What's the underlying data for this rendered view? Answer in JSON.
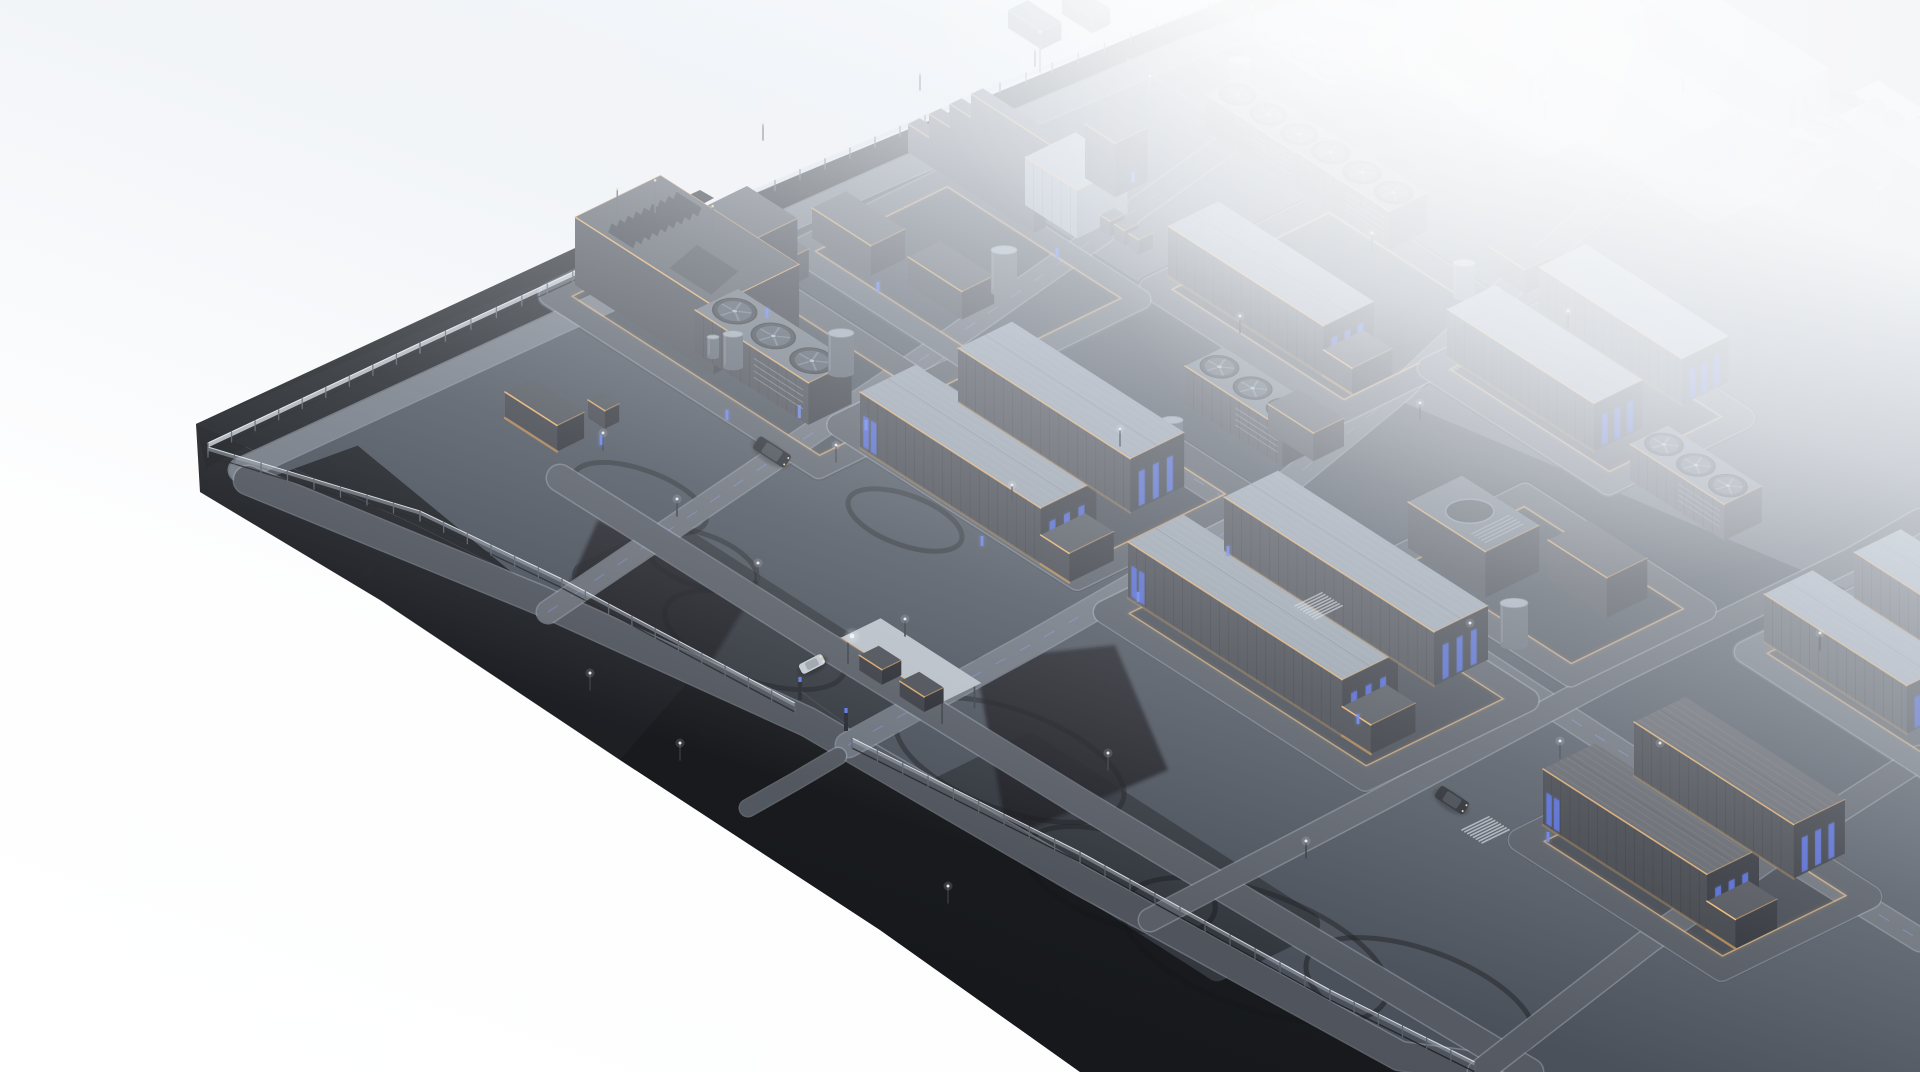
{
  "meta": {
    "scene": "battery-energy-storage-facility-aerial-render"
  },
  "projection": {
    "u": [
      0.84,
      0.54
    ],
    "v": [
      0.9,
      -0.44
    ]
  },
  "colors": {
    "void": "#ffffff",
    "fog": "#c9d1db",
    "soil": "#191c21",
    "facetA": "#15171a",
    "facetB": "#1a1c21",
    "facetDark": "#101216",
    "outside": "#404347",
    "pavement": "#333942",
    "pad": "#282d35",
    "asphalt": "#3f444c",
    "roadEdge": "#9aa2ad",
    "roof": "#8d96a1",
    "roofDark": "#4c4f54",
    "fanRoof": "#5d646d",
    "slabTop": "#3a3d43",
    "wallSide": "#27292e",
    "wallEnd": "#15171c",
    "boxLightWall": "#8e99a4",
    "boxLightWall2": "#6d7883",
    "boxLightRoof": "#a9b1bb",
    "tankBody": "#464c55",
    "tankTop": "#97a0aa",
    "amber": "#ffb964",
    "amberDim": "#c98d42",
    "blue": "#3c55d6",
    "blueBright": "#5b79f0",
    "fence": "#e4e9f0",
    "fencePost": "#565c64"
  },
  "platform": {
    "surface": [
      [
        196,
        424
      ],
      [
        1245,
        -10
      ],
      [
        1520,
        -10
      ],
      [
        1920,
        118
      ],
      [
        1920,
        1072
      ],
      [
        1470,
        1072
      ],
      [
        1300,
        985
      ],
      [
        1000,
        830
      ],
      [
        700,
        668
      ],
      [
        420,
        527
      ]
    ],
    "facetA": [
      [
        196,
        424
      ],
      [
        700,
        190
      ],
      [
        714,
        198
      ],
      [
        206,
        468
      ]
    ],
    "facetB": [
      [
        196,
        424
      ],
      [
        420,
        527
      ],
      [
        700,
        668
      ],
      [
        1000,
        830
      ],
      [
        1300,
        985
      ],
      [
        1470,
        1072
      ],
      [
        1080,
        1072
      ],
      [
        880,
        930
      ],
      [
        620,
        760
      ],
      [
        380,
        600
      ],
      [
        200,
        492
      ]
    ],
    "outsideNE": [
      [
        1520,
        -10
      ],
      [
        1928,
        -10
      ],
      [
        1928,
        128
      ]
    ],
    "pavement": [
      [
        360,
        432
      ],
      [
        250,
        472
      ],
      [
        575,
        330
      ],
      [
        905,
        175
      ],
      [
        1190,
        52
      ],
      [
        1325,
        6
      ],
      [
        1540,
        10
      ],
      [
        1800,
        96
      ],
      [
        1920,
        152
      ],
      [
        1920,
        1072
      ],
      [
        1520,
        1072
      ],
      [
        1400,
        1058
      ],
      [
        1080,
        880
      ],
      [
        808,
        724
      ],
      [
        562,
        598
      ],
      [
        360,
        432
      ]
    ]
  },
  "soilPatches": [
    [
      [
        975,
        660
      ],
      [
        1115,
        645
      ],
      [
        1168,
        770
      ],
      [
        1008,
        838
      ]
    ],
    [
      [
        598,
        520
      ],
      [
        758,
        586
      ],
      [
        700,
        680
      ],
      [
        558,
        610
      ]
    ]
  ],
  "fences": {
    "nw": [
      [
        208,
        452
      ],
      [
        420,
        352
      ],
      [
        700,
        222
      ],
      [
        1000,
        92
      ],
      [
        1235,
        2
      ]
    ],
    "sw1": [
      [
        208,
        456
      ],
      [
        420,
        520
      ],
      [
        562,
        588
      ],
      [
        795,
        712
      ]
    ],
    "sw2": [
      [
        852,
        748
      ],
      [
        1080,
        862
      ],
      [
        1330,
        1000
      ],
      [
        1475,
        1072
      ]
    ],
    "ne": [
      [
        1520,
        36
      ],
      [
        1700,
        88
      ],
      [
        1860,
        136
      ],
      [
        1920,
        152
      ]
    ]
  },
  "roads": [
    {
      "pts": [
        [
          240,
          470
        ],
        [
          560,
          322
        ],
        [
          905,
          168
        ],
        [
          1190,
          48
        ],
        [
          1325,
          4
        ]
      ],
      "w": 22,
      "f": 0.35
    },
    {
      "pts": [
        [
          248,
          480
        ],
        [
          540,
          600
        ],
        [
          808,
          722
        ],
        [
          1080,
          880
        ],
        [
          1400,
          1056
        ],
        [
          1520,
          1072
        ]
      ],
      "w": 28,
      "f": 0.08
    },
    {
      "pts": [
        [
          1325,
          4
        ],
        [
          1560,
          62
        ],
        [
          1800,
          128
        ],
        [
          1920,
          158
        ]
      ],
      "w": 18,
      "f": 0.72
    },
    {
      "pts": [
        [
          848,
          745
        ],
        [
          1030,
          645
        ],
        [
          1230,
          530
        ],
        [
          1400,
          390
        ],
        [
          1530,
          268
        ],
        [
          1640,
          172
        ],
        [
          1735,
          100
        ]
      ],
      "w": 24,
      "f": 0.3,
      "dash": 1
    },
    {
      "pts": [
        [
          548,
          612
        ],
        [
          740,
          482
        ],
        [
          950,
          340
        ],
        [
          1135,
          210
        ],
        [
          1240,
          135
        ]
      ],
      "w": 22,
      "f": 0.25,
      "dash": 1
    },
    {
      "pts": [
        [
          560,
          478
        ],
        [
          820,
          642
        ],
        [
          1080,
          802
        ],
        [
          1330,
          952
        ],
        [
          1530,
          1072
        ]
      ],
      "w": 26,
      "f": 0.12
    },
    {
      "pts": [
        [
          1005,
          358
        ],
        [
          1215,
          492
        ],
        [
          1480,
          660
        ],
        [
          1720,
          816
        ],
        [
          1920,
          940
        ]
      ],
      "w": 22,
      "f": 0.2,
      "dash": 1
    },
    {
      "pts": [
        [
          1150,
          920
        ],
        [
          1380,
          800
        ],
        [
          1620,
          672
        ],
        [
          1850,
          560
        ],
        [
          1920,
          520
        ]
      ],
      "w": 22,
      "f": 0.15
    },
    {
      "pts": [
        [
          1480,
          1072
        ],
        [
          1650,
          940
        ],
        [
          1820,
          822
        ],
        [
          1920,
          758
        ]
      ],
      "w": 24,
      "f": 0.12
    },
    {
      "pts": [
        [
          838,
          756
        ],
        [
          794,
          782
        ],
        [
          748,
          808
        ]
      ],
      "w": 16,
      "f": 0.1
    }
  ],
  "loops": [
    {
      "F": [
        550,
        295
      ],
      "a": 320,
      "b": 150,
      "w": 20,
      "f": 0.12
    },
    {
      "F": [
        838,
        425
      ],
      "a": 285,
      "b": 190,
      "w": 21,
      "f": 0.1
    },
    {
      "F": [
        1150,
        288
      ],
      "a": 230,
      "b": 200,
      "w": 20,
      "f": 0.2
    },
    {
      "F": [
        1428,
        368
      ],
      "a": 215,
      "b": 150,
      "w": 20,
      "f": 0.28
    },
    {
      "F": [
        1535,
        98
      ],
      "a": 210,
      "b": 150,
      "w": 18,
      "f": 0.5
    },
    {
      "F": [
        1105,
        612
      ],
      "a": 310,
      "b": 180,
      "w": 22,
      "f": 0.1
    },
    {
      "F": [
        1520,
        840
      ],
      "a": 240,
      "b": 165,
      "w": 22,
      "f": 0.05
    },
    {
      "F": [
        1745,
        652
      ],
      "a": 215,
      "b": 150,
      "w": 20,
      "f": 0.26
    },
    {
      "F": [
        1378,
        40
      ],
      "a": 195,
      "b": 135,
      "w": 18,
      "f": 0.58
    },
    {
      "F": [
        1390,
        560
      ],
      "a": 215,
      "b": 150,
      "w": 20,
      "f": 0.15
    },
    {
      "F": [
        795,
        250
      ],
      "a": 230,
      "b": 170,
      "w": 18,
      "f": 0.22
    }
  ],
  "pads": [
    {
      "F": [
        585,
        575
      ],
      "a": 310,
      "b": 95
    },
    {
      "F": [
        940,
        790
      ],
      "a": 330,
      "b": 100
    }
  ],
  "tireMarks": [
    [
      755,
      640,
      95,
      40
    ],
    [
      1010,
      760,
      120,
      50
    ],
    [
      1255,
      950,
      140,
      58
    ],
    [
      640,
      498,
      70,
      28
    ],
    [
      1120,
      880,
      100,
      44
    ],
    [
      700,
      560,
      60,
      26
    ],
    [
      1420,
      1000,
      120,
      50
    ],
    [
      905,
      520,
      60,
      25
    ]
  ],
  "buildings": [
    {
      "t": "container",
      "x": 1395,
      "y": 28,
      "l": 150,
      "w": 46,
      "h": 40,
      "f": 0.6,
      "bl": 1
    },
    {
      "t": "container",
      "x": 1490,
      "y": -12,
      "l": 140,
      "w": 44,
      "h": 38,
      "f": 0.64
    },
    {
      "t": "container",
      "x": 1553,
      "y": 88,
      "l": 170,
      "w": 52,
      "h": 46,
      "f": 0.5,
      "bl": 1
    },
    {
      "t": "container",
      "x": 1645,
      "y": 45,
      "l": 165,
      "w": 50,
      "h": 44,
      "f": 0.55,
      "bl": 1
    },
    {
      "t": "container",
      "x": 1838,
      "y": 158,
      "l": 140,
      "w": 48,
      "h": 42,
      "f": 0.52,
      "bl": 1
    },
    {
      "t": "canopy",
      "x": 1860,
      "y": 108,
      "l": 50,
      "w": 20,
      "h": 15,
      "f": 0.55
    },
    {
      "t": "box",
      "x": 1008,
      "y": 28,
      "l": 40,
      "w": 22,
      "h": 18,
      "f": 0.5
    },
    {
      "t": "box",
      "x": 1062,
      "y": 14,
      "l": 36,
      "w": 20,
      "h": 16,
      "f": 0.55
    },
    {
      "t": "mast",
      "x": 1040,
      "y": 72,
      "h": 40,
      "f": 0.5
    },
    {
      "t": "slab",
      "x": 908,
      "y": 152,
      "l": 150,
      "w": 13,
      "h": 28,
      "f": 0.3
    },
    {
      "t": "slab",
      "x": 929,
      "y": 142,
      "l": 150,
      "w": 13,
      "h": 28,
      "f": 0.3
    },
    {
      "t": "slab",
      "x": 950,
      "y": 132,
      "l": 150,
      "w": 13,
      "h": 28,
      "f": 0.3
    },
    {
      "t": "slab",
      "x": 971,
      "y": 122,
      "l": 150,
      "w": 13,
      "h": 28,
      "f": 0.3
    },
    {
      "t": "box",
      "x": 812,
      "y": 238,
      "l": 70,
      "w": 38,
      "h": 30,
      "f": 0.22
    },
    {
      "t": "box",
      "x": 908,
      "y": 285,
      "l": 64,
      "w": 36,
      "h": 28,
      "f": 0.2
    },
    {
      "t": "box",
      "x": 738,
      "y": 264,
      "l": 50,
      "w": 32,
      "h": 28,
      "f": 0.18
    },
    {
      "t": "boxlight",
      "x": 1025,
      "y": 205,
      "l": 62,
      "w": 56,
      "h": 48,
      "f": 0.28
    },
    {
      "t": "box",
      "x": 1085,
      "y": 178,
      "l": 36,
      "w": 36,
      "h": 54,
      "f": 0.3
    },
    {
      "t": "rack",
      "x": 1128,
      "y": 90,
      "l": 98,
      "h": 30,
      "f": 0.4
    },
    {
      "t": "mast",
      "x": 1150,
      "y": 120,
      "h": 44,
      "f": 0.35
    },
    {
      "t": "tank",
      "x": 1240,
      "y": 96,
      "r": 11,
      "h": 36,
      "f": 0.42
    },
    {
      "t": "tank",
      "x": 1004,
      "y": 292,
      "r": 13,
      "h": 42,
      "f": 0.22
    },
    {
      "t": "cabinets",
      "x": 1100,
      "y": 230,
      "n": 3,
      "f": 0.3
    },
    {
      "t": "fanunit",
      "x": 1252,
      "y": 68,
      "l": 92,
      "w": 36,
      "h": 32,
      "n": 3,
      "f": 0.45
    },
    {
      "t": "fanunit",
      "x": 1205,
      "y": 130,
      "l": 108,
      "w": 40,
      "h": 36,
      "n": 3,
      "f": 0.3
    },
    {
      "t": "container",
      "x": 1168,
      "y": 276,
      "l": 185,
      "w": 56,
      "h": 50,
      "f": 0.2,
      "bl": 1,
      "ax": 1
    },
    {
      "t": "fanunit",
      "x": 1297,
      "y": 190,
      "l": 110,
      "w": 42,
      "h": 38,
      "n": 3,
      "f": 0.28
    },
    {
      "t": "tank",
      "x": 1464,
      "y": 297,
      "r": 11,
      "h": 34,
      "f": 0.3
    },
    {
      "t": "box",
      "x": 1488,
      "y": 270,
      "l": 44,
      "w": 28,
      "h": 24,
      "f": 0.3
    },
    {
      "t": "container",
      "x": 1447,
      "y": 357,
      "l": 175,
      "w": 54,
      "h": 48,
      "f": 0.28,
      "bl": 1
    },
    {
      "t": "container",
      "x": 1539,
      "y": 313,
      "l": 170,
      "w": 52,
      "h": 46,
      "f": 0.32,
      "bl": 1
    },
    {
      "t": "dome",
      "x": 1408,
      "y": 548,
      "l": 92,
      "w": 60,
      "h": 46,
      "f": 0.16
    },
    {
      "t": "tank",
      "x": 1514,
      "y": 645,
      "r": 14,
      "h": 42,
      "f": 0.15
    },
    {
      "t": "box",
      "x": 1548,
      "y": 580,
      "l": 70,
      "w": 45,
      "h": 40,
      "f": 0.18
    },
    {
      "t": "fanunit",
      "x": 1630,
      "y": 480,
      "l": 112,
      "w": 42,
      "h": 36,
      "n": 3,
      "f": 0.3
    },
    {
      "t": "container",
      "x": 1764,
      "y": 642,
      "l": 170,
      "w": 54,
      "h": 48,
      "f": 0.26,
      "bl": 1
    },
    {
      "t": "container",
      "x": 1854,
      "y": 598,
      "l": 160,
      "w": 52,
      "h": 46,
      "f": 0.3
    },
    {
      "t": "box",
      "x": 702,
      "y": 268,
      "l": 60,
      "w": 50,
      "h": 60,
      "f": 0.14,
      "bt": 1
    },
    {
      "t": "box",
      "x": 575,
      "y": 285,
      "l": 165,
      "w": 95,
      "h": 68,
      "f": 0.12,
      "rt": 1
    },
    {
      "t": "fanunit",
      "x": 695,
      "y": 352,
      "l": 135,
      "w": 48,
      "h": 42,
      "n": 3,
      "f": 0.1,
      "bb": 1
    },
    {
      "t": "tank",
      "x": 733,
      "y": 367,
      "r": 10,
      "h": 33,
      "f": 0.1
    },
    {
      "t": "tank",
      "x": 713,
      "y": 357,
      "r": 6,
      "h": 20,
      "f": 0.1
    },
    {
      "t": "tank",
      "x": 841,
      "y": 373,
      "r": 13,
      "h": 40,
      "f": 0.1
    },
    {
      "t": "box",
      "x": 505,
      "y": 418,
      "l": 62,
      "w": 30,
      "h": 26,
      "f": 0.08,
      "wm": 1
    },
    {
      "t": "box",
      "x": 588,
      "y": 418,
      "l": 20,
      "w": 16,
      "h": 18,
      "f": 0.08
    },
    {
      "t": "fanunit",
      "x": 1185,
      "y": 404,
      "l": 116,
      "w": 42,
      "h": 38,
      "n": 3,
      "f": 0.18
    },
    {
      "t": "tank",
      "x": 1172,
      "y": 462,
      "r": 11,
      "h": 42,
      "f": 0.15
    },
    {
      "t": "box",
      "x": 1268,
      "y": 432,
      "l": 54,
      "w": 34,
      "h": 28,
      "f": 0.2
    },
    {
      "t": "container",
      "x": 860,
      "y": 448,
      "l": 215,
      "w": 62,
      "h": 56,
      "f": 0.1,
      "bl": 1,
      "bf": 1,
      "ax": 1
    },
    {
      "t": "container",
      "x": 958,
      "y": 402,
      "l": 205,
      "w": 60,
      "h": 54,
      "f": 0.13,
      "bl": 1
    },
    {
      "t": "container",
      "x": 1128,
      "y": 598,
      "l": 255,
      "w": 62,
      "h": 56,
      "f": 0.1,
      "bl": 1,
      "bf": 1,
      "ax": 1
    },
    {
      "t": "container",
      "x": 1224,
      "y": 551,
      "l": 250,
      "w": 60,
      "h": 54,
      "f": 0.13,
      "bl": 1
    },
    {
      "t": "stairs",
      "x": 1295,
      "y": 614,
      "l": 26,
      "w": 30,
      "f": 0.12
    },
    {
      "t": "stairs",
      "x": 1462,
      "y": 838,
      "l": 26,
      "w": 30,
      "f": 0.05
    },
    {
      "t": "container",
      "x": 1543,
      "y": 825,
      "l": 195,
      "w": 58,
      "h": 56,
      "f": 0.04,
      "bl": 1,
      "bf": 1,
      "dr": 1,
      "ax": 1
    },
    {
      "t": "container",
      "x": 1634,
      "y": 776,
      "l": 190,
      "w": 57,
      "h": 54,
      "f": 0.07,
      "bl": 1,
      "dr": 1
    },
    {
      "t": "gatehouse",
      "x": 848,
      "y": 663,
      "l": 112,
      "w": 36,
      "h": 25,
      "f": 0.05
    }
  ],
  "poles": [
    [
      603,
      450
    ],
    [
      677,
      516
    ],
    [
      758,
      580
    ],
    [
      836,
      462
    ],
    [
      905,
      636
    ],
    [
      1012,
      502
    ],
    [
      948,
      903
    ],
    [
      1108,
      770
    ],
    [
      1306,
      858
    ],
    [
      1470,
      640
    ],
    [
      1560,
      758
    ],
    [
      1120,
      446
    ],
    [
      1240,
      333
    ],
    [
      1372,
      250
    ],
    [
      1420,
      420
    ],
    [
      1568,
      328
    ],
    [
      1660,
      760
    ],
    [
      1820,
      650
    ],
    [
      1545,
      116
    ],
    [
      1035,
      66
    ],
    [
      1252,
      24
    ],
    [
      1683,
      92
    ],
    [
      1880,
      205
    ],
    [
      920,
      90
    ],
    [
      763,
      140
    ],
    [
      590,
      690
    ],
    [
      680,
      760
    ]
  ],
  "bollards": [
    [
      601,
      445
    ],
    [
      727,
      420
    ],
    [
      1057,
      258
    ],
    [
      878,
      292
    ],
    [
      1133,
      182
    ],
    [
      866,
      430
    ],
    [
      1138,
      602
    ],
    [
      1358,
      724
    ],
    [
      1548,
      842
    ],
    [
      982,
      546
    ],
    [
      1228,
      556
    ],
    [
      767,
      318
    ]
  ],
  "gate": {
    "pillars": [
      [
        800,
        700
      ],
      [
        846,
        731
      ]
    ],
    "lamp": [
      852,
      636
    ]
  },
  "cars": [
    {
      "x": 772,
      "y": 452,
      "a": 33,
      "l": 38,
      "w": 15,
      "c": "#101317"
    },
    {
      "x": 1452,
      "y": 800,
      "a": 33,
      "l": 34,
      "w": 14,
      "c": "#14171c"
    },
    {
      "x": 812,
      "y": 664,
      "a": -27,
      "l": 26,
      "w": 11,
      "c": "#c3c9d0"
    }
  ]
}
